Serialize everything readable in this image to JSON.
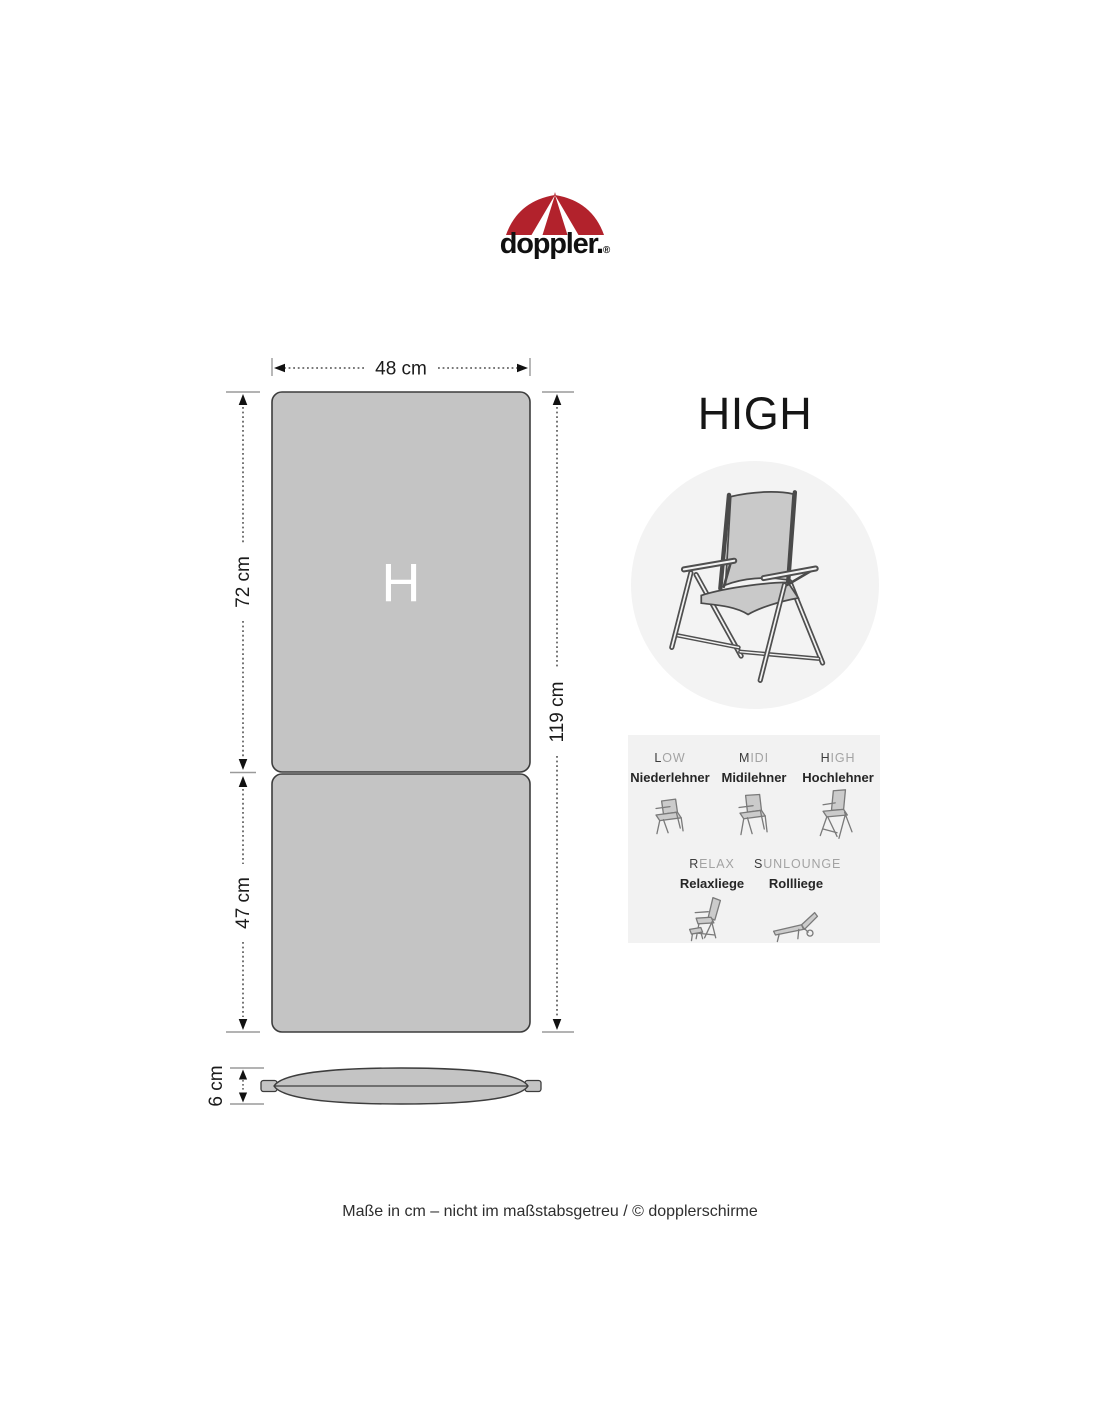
{
  "brand": {
    "wordmark": "doppler.",
    "registered": "®",
    "umbrella_red": "#b2222c"
  },
  "page": {
    "title": "HIGH",
    "footer": "Maße in cm – nicht im maßstabsgetreu / © dopplerschirme"
  },
  "diagram": {
    "cushion_letter": "H",
    "cushion_gray": "#c4c4c4",
    "panel_gray": "#f2f2f2",
    "dims": {
      "width": "48 cm",
      "back": "72 cm",
      "seat": "47 cm",
      "total": "119 cm",
      "thickness": "6 cm"
    }
  },
  "types": [
    {
      "initial": "L",
      "rest": "OW",
      "name": "Niederlehner"
    },
    {
      "initial": "M",
      "rest": "IDI",
      "name": "Midilehner"
    },
    {
      "initial": "H",
      "rest": "IGH",
      "name": "Hochlehner"
    },
    {
      "initial": "R",
      "rest": "ELAX",
      "name": "Relaxliege"
    },
    {
      "initial": "S",
      "rest": "UNLOUNGE",
      "name": "Rollliege"
    }
  ]
}
